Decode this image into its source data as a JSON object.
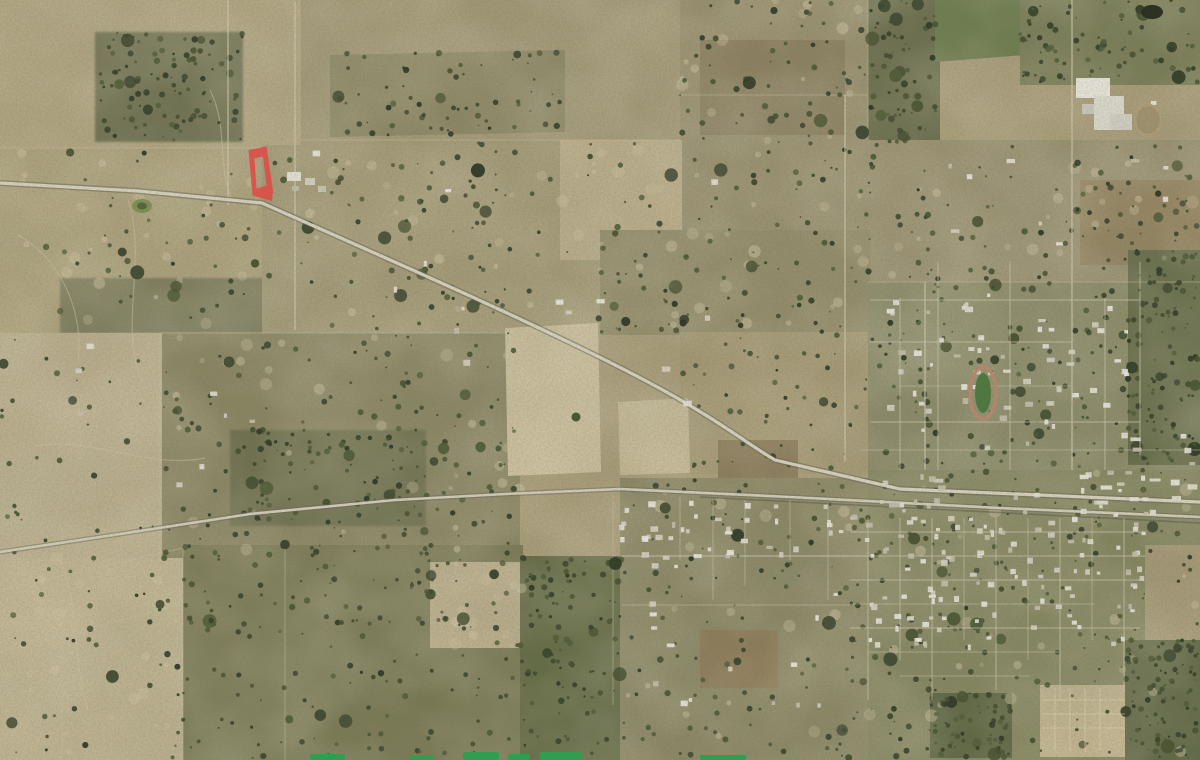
{
  "map": {
    "kind": "aerial-satellite-imagery",
    "features": [
      "highlighted-parcel-outline",
      "diagonal-highway",
      "railroad-corridor",
      "section-line-roads",
      "small-town-street-grid",
      "football-stadium",
      "industrial-buildings",
      "stock-ponds",
      "scrub-and-pasture-fields",
      "watermark-fragments"
    ],
    "highlighted_parcel": {
      "shape": "narrow quadrilateral ring outline",
      "approx_position": "x 248-273, y 146-201"
    }
  },
  "colors": {
    "parcel_red": "#db4f47",
    "watermark_green": "#2f9e51",
    "road_light": "#dcd6c4",
    "corridor_light": "#d7d1bf",
    "stadium_green": "#4d7a3d",
    "track_tan": "#bd8a6e",
    "terrain_base": "#ac9f7a",
    "dark_trees": "#3a452c"
  }
}
